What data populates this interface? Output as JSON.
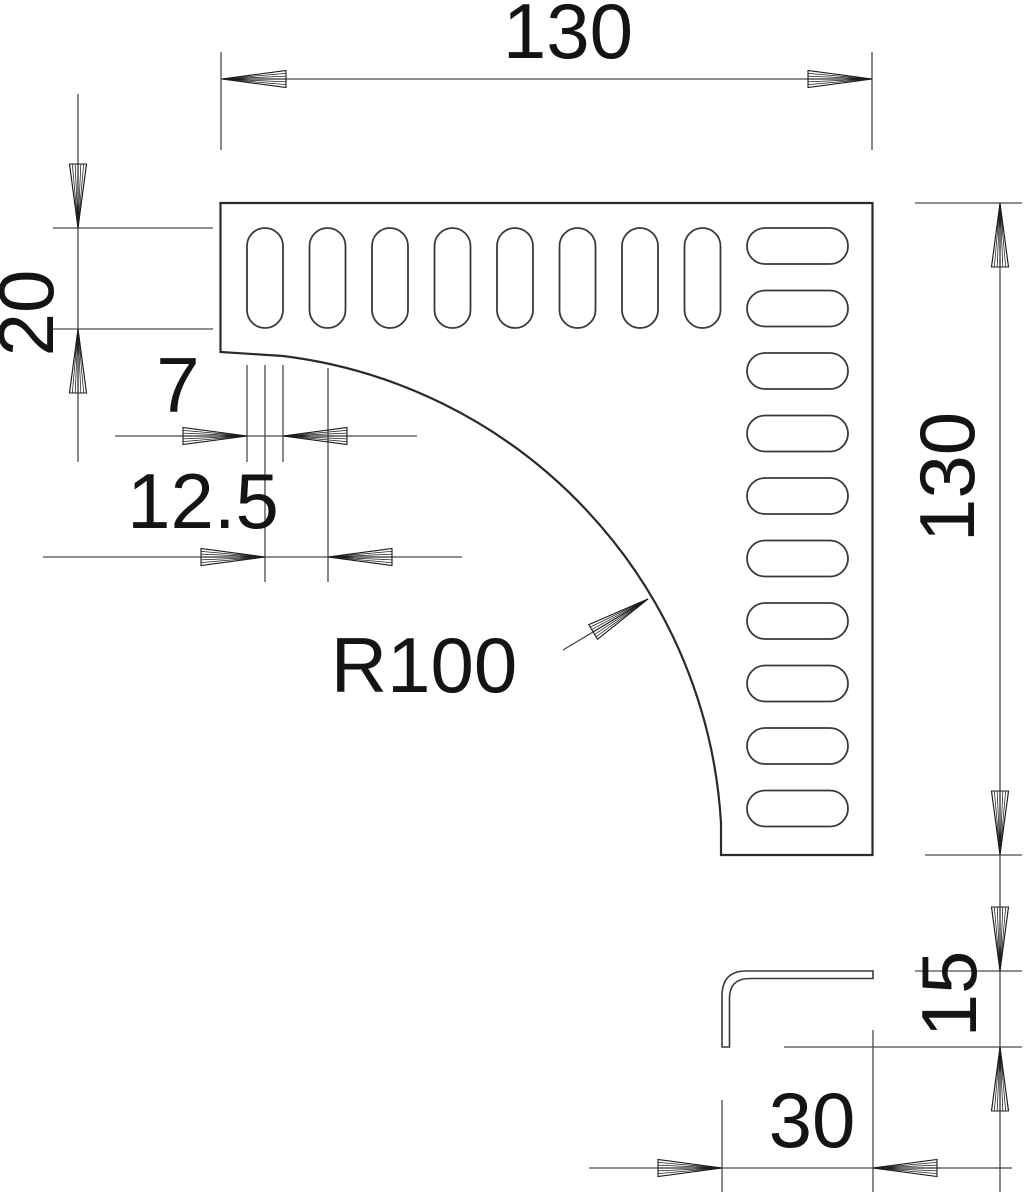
{
  "drawing": {
    "background_color": "#ffffff",
    "line_color": "#4a4a4a",
    "outline_color": "#2b2b2b",
    "text_color": "#141414",
    "labels": {
      "width_top": "130",
      "slot_length": "20",
      "slot_width": "7",
      "slot_pitch": "12.5",
      "corner_radius": "R100",
      "height_right": "130",
      "profile_height": "15",
      "profile_width": "30"
    },
    "geometry": {
      "vertical_slots": {
        "count": 8,
        "x_start": 247,
        "pitch": 62.5,
        "y_top": 228,
        "slot_width": 36,
        "slot_length": 100,
        "corner_radius": 18
      },
      "horizontal_slots": {
        "count": 10,
        "y_start": 228,
        "pitch": 62.5,
        "x_left": 747,
        "slot_length": 101,
        "slot_width": 36,
        "corner_radius": 18
      }
    }
  }
}
